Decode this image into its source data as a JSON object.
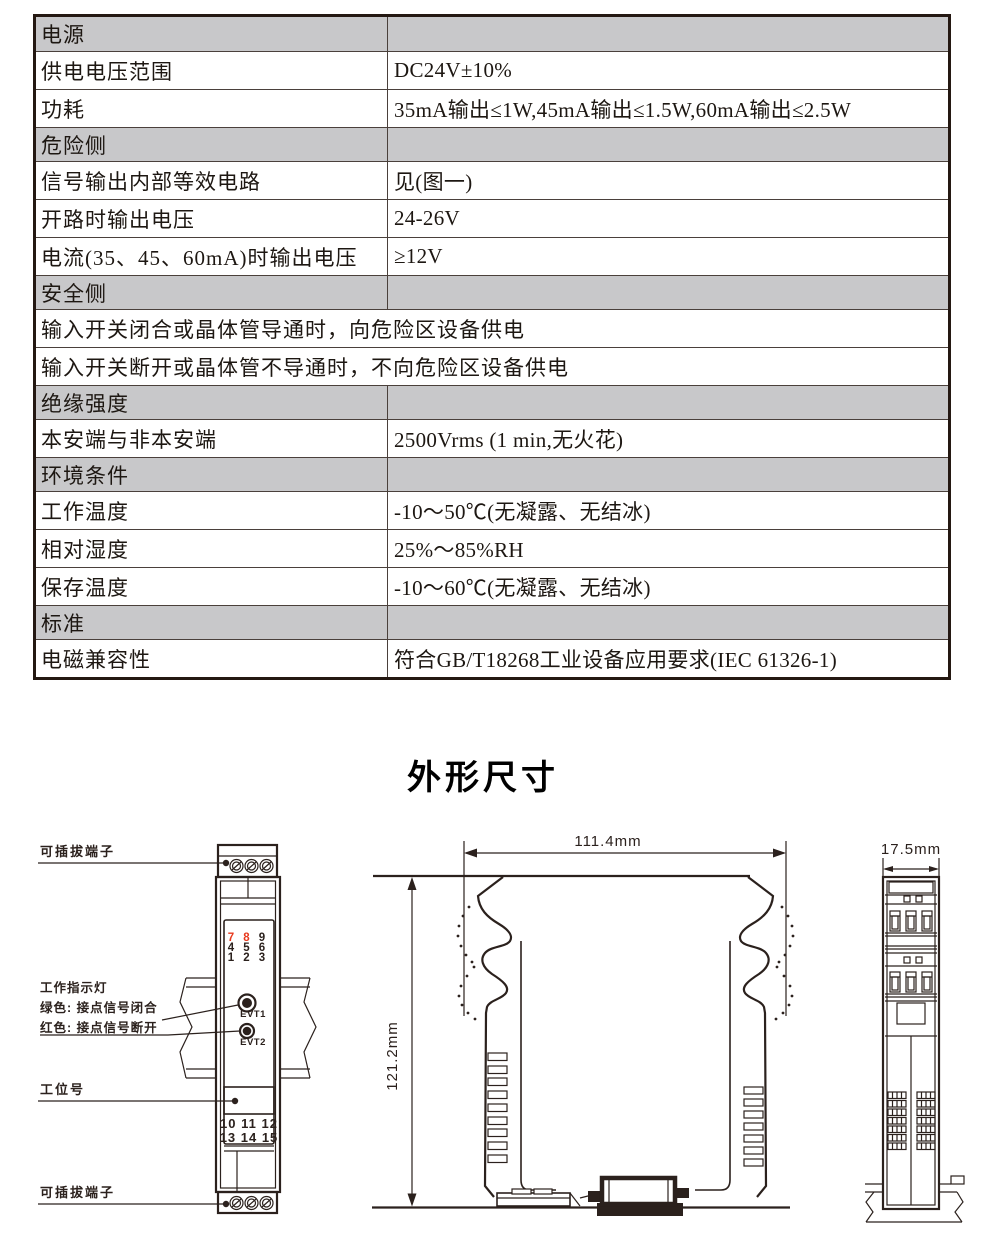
{
  "colors": {
    "line": "#2b211d",
    "table_section_bg": "#c8c8ca",
    "red_terminal": "#e8391d"
  },
  "table": {
    "rows": [
      {
        "type": "section",
        "label": "电源"
      },
      {
        "type": "kv",
        "label": "供电电压范围",
        "value": "DC24V±10%"
      },
      {
        "type": "kv",
        "label": "功耗",
        "value": "35mA输出≤1W,45mA输出≤1.5W,60mA输出≤2.5W"
      },
      {
        "type": "section",
        "label": "危险侧"
      },
      {
        "type": "kv",
        "label": "信号输出内部等效电路",
        "value": "见(图一)"
      },
      {
        "type": "kv",
        "label": "开路时输出电压",
        "value": "24-26V"
      },
      {
        "type": "kv",
        "label": "电流(35、45、60mA)时输出电压",
        "value": "≥12V"
      },
      {
        "type": "section",
        "label": "安全侧"
      },
      {
        "type": "full",
        "label": "输入开关闭合或晶体管导通时，向危险区设备供电"
      },
      {
        "type": "full",
        "label": "输入开关断开或晶体管不导通时，不向危险区设备供电"
      },
      {
        "type": "section",
        "label": "绝缘强度"
      },
      {
        "type": "kv",
        "label": "本安端与非本安端",
        "value": "2500Vrms (1 min,无火花)"
      },
      {
        "type": "section",
        "label": "环境条件"
      },
      {
        "type": "kv",
        "label": "工作温度",
        "value": "-10～50℃(无凝露、无结冰)"
      },
      {
        "type": "kv",
        "label": "相对湿度",
        "value": "25%～85%RH"
      },
      {
        "type": "kv",
        "label": "保存温度",
        "value": "-10～60℃(无凝露、无结冰)"
      },
      {
        "type": "section",
        "label": "标准"
      },
      {
        "type": "kv",
        "label": "电磁兼容性",
        "value": "符合GB/T18268工业设备应用要求(IEC 61326-1)"
      }
    ]
  },
  "section_title": "外形尺寸",
  "front_view": {
    "labels": {
      "terminal_top": "可插拔端子",
      "indicator_title": "工作指示灯",
      "indicator_green": "绿色: 接点信号闭合",
      "indicator_red": "红色: 接点信号断开",
      "station": "工位号",
      "terminal_bottom": "可插拔端子"
    },
    "grid": [
      "7",
      "8",
      "9",
      "4",
      "5",
      "6",
      "1",
      "2",
      "3"
    ],
    "red_terminals": [
      "7",
      "8"
    ],
    "leds": [
      "EVT1",
      "EVT2"
    ],
    "bottom_row1": "10 11 12",
    "bottom_row2": "13 14 15"
  },
  "dimensions": {
    "width": "111.4mm",
    "height": "121.2mm",
    "depth": "17.5mm"
  }
}
